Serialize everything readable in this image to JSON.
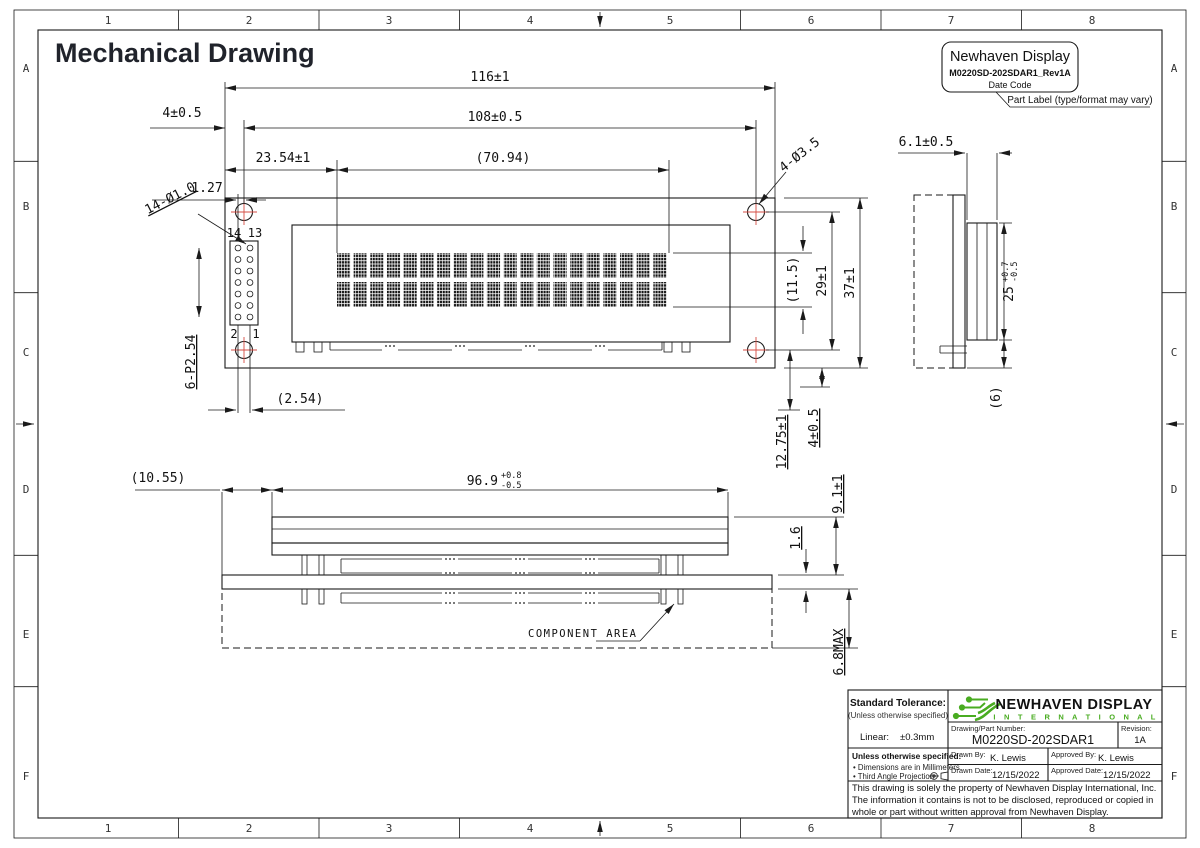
{
  "page": {
    "title": "Mechanical Drawing"
  },
  "zones": {
    "cols": [
      "1",
      "2",
      "3",
      "4",
      "5",
      "6",
      "7",
      "8"
    ],
    "rows": [
      "A",
      "B",
      "C",
      "D",
      "E",
      "F"
    ]
  },
  "part_label": {
    "title": "Newhaven Display",
    "part": "M0220SD-202SDAR1_Rev1A",
    "date": "Date Code",
    "callout": "Part Label (type/format may vary)"
  },
  "front": {
    "d116": "116±1",
    "d108": "108±0.5",
    "d2354": "23.54±1",
    "d127": "1.27",
    "d7094": "(70.94)",
    "d4off": "4±0.5",
    "dholes": "4-Ø3.5",
    "dpins": "14-Ø1.0",
    "dconn": "6-P2.54",
    "d254": "(2.54)",
    "d115": "(11.5)",
    "d29": "29±1",
    "d37": "37±1",
    "d1275": "12.75±1",
    "d4pin": "4±0.5",
    "pin_tl": "14",
    "pin_tr": "13",
    "pin_bl": "2",
    "pin_br": "1"
  },
  "side": {
    "d61": "6.1±0.5",
    "d25": "25",
    "d25p": "+0.7",
    "d25m": "-0.5",
    "d6": "(6)"
  },
  "bottom": {
    "d1055": "(10.55)",
    "d969": "96.9",
    "d969p": "+0.8",
    "d969m": "-0.5",
    "d91": "9.1±1",
    "d16": "1.6",
    "d68": "6.8MAX",
    "component_area": "COMPONENT AREA"
  },
  "title_block": {
    "tolerance": {
      "heading": "Standard Tolerance:",
      "sub": "(Unless otherwise specified)",
      "linear_label": "Linear:",
      "linear_value": "±0.3mm"
    },
    "notes": {
      "heading": "Unless otherwise specified:",
      "items": [
        "• Dimensions are in Millimeters",
        "• Third Angle Projection"
      ]
    },
    "logo": {
      "name": "NEWHAVEN DISPLAY",
      "subname": "I N T E R N A T I O N A L"
    },
    "part_number_label": "Drawing/Part Number:",
    "part_number": "M0220SD-202SDAR1",
    "revision_label": "Revision:",
    "revision": "1A",
    "drawn_by_label": "Drawn By:",
    "drawn_by": "K. Lewis",
    "approved_by_label": "Approved By:",
    "approved_by": "K. Lewis",
    "drawn_date_label": "Drawn Date:",
    "drawn_date": "12/15/2022",
    "approved_date_label": "Approved Date:",
    "approved_date": "12/15/2022",
    "disclaimer": "This drawing is solely the property of Newhaven Display International, Inc. The information it contains is not to be disclosed, reproduced or copied in whole or part without written approval from Newhaven Display."
  },
  "colors": {
    "line": "#1a1a1a",
    "hole_red": "#d44d44",
    "logo_green": "#49ac21",
    "title": "#20232b"
  }
}
